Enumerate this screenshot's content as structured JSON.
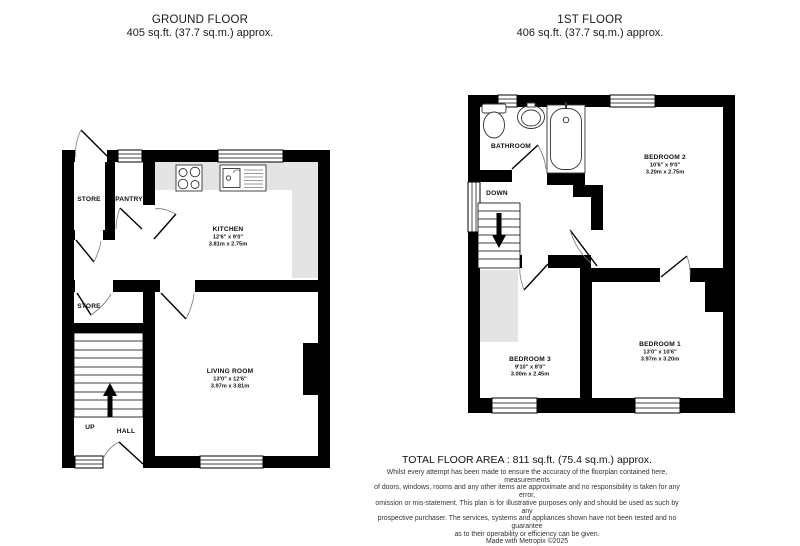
{
  "ground_floor": {
    "title": "GROUND FLOOR",
    "area": "405 sq.ft. (37.7 sq.m.) approx.",
    "rooms": {
      "store1": {
        "name": "STORE"
      },
      "pantry": {
        "name": "PANTRY"
      },
      "kitchen": {
        "name": "KITCHEN",
        "imperial": "12'6\" x 9'0\"",
        "metric": "3.81m x 2.75m"
      },
      "store2": {
        "name": "STORE"
      },
      "living": {
        "name": "LIVING ROOM",
        "imperial": "13'0\" x 12'6\"",
        "metric": "3.97m x 3.81m"
      },
      "hall": {
        "name": "HALL"
      },
      "stairs": {
        "direction": "UP"
      }
    }
  },
  "first_floor": {
    "title": "1ST FLOOR",
    "area": "406 sq.ft. (37.7 sq.m.) approx.",
    "rooms": {
      "bathroom": {
        "name": "BATHROOM"
      },
      "bedroom2": {
        "name": "BEDROOM 2",
        "imperial": "10'6\" x 9'0\"",
        "metric": "3.20m x 2.75m"
      },
      "bedroom3": {
        "name": "BEDROOM 3",
        "imperial": "9'10\" x 8'0\"",
        "metric": "3.00m x 2.45m"
      },
      "bedroom1": {
        "name": "BEDROOM 1",
        "imperial": "13'0\" x 10'6\"",
        "metric": "3.97m x 3.20m"
      },
      "stairs": {
        "direction": "DOWN"
      }
    }
  },
  "footer": {
    "total_area": "TOTAL FLOOR AREA : 811 sq.ft. (75.4 sq.m.) approx.",
    "disclaimer_lines": [
      "Whilst every attempt has been made to ensure the accuracy of the floorplan contained here, measurements",
      "of doors, windows, rooms and any other items are approximate and no responsibility is taken for any error,",
      "omission or mis-statement. This plan is for illustrative purposes only and should be used as such by any",
      "prospective purchaser. The services, systems and appliances shown have not been tested and no guarantee",
      "as to their operability or efficiency can be given.",
      "Made with Metropix ©2025"
    ]
  },
  "colors": {
    "wall": "#000000",
    "counter": "#e4e4e4",
    "background": "#ffffff"
  }
}
